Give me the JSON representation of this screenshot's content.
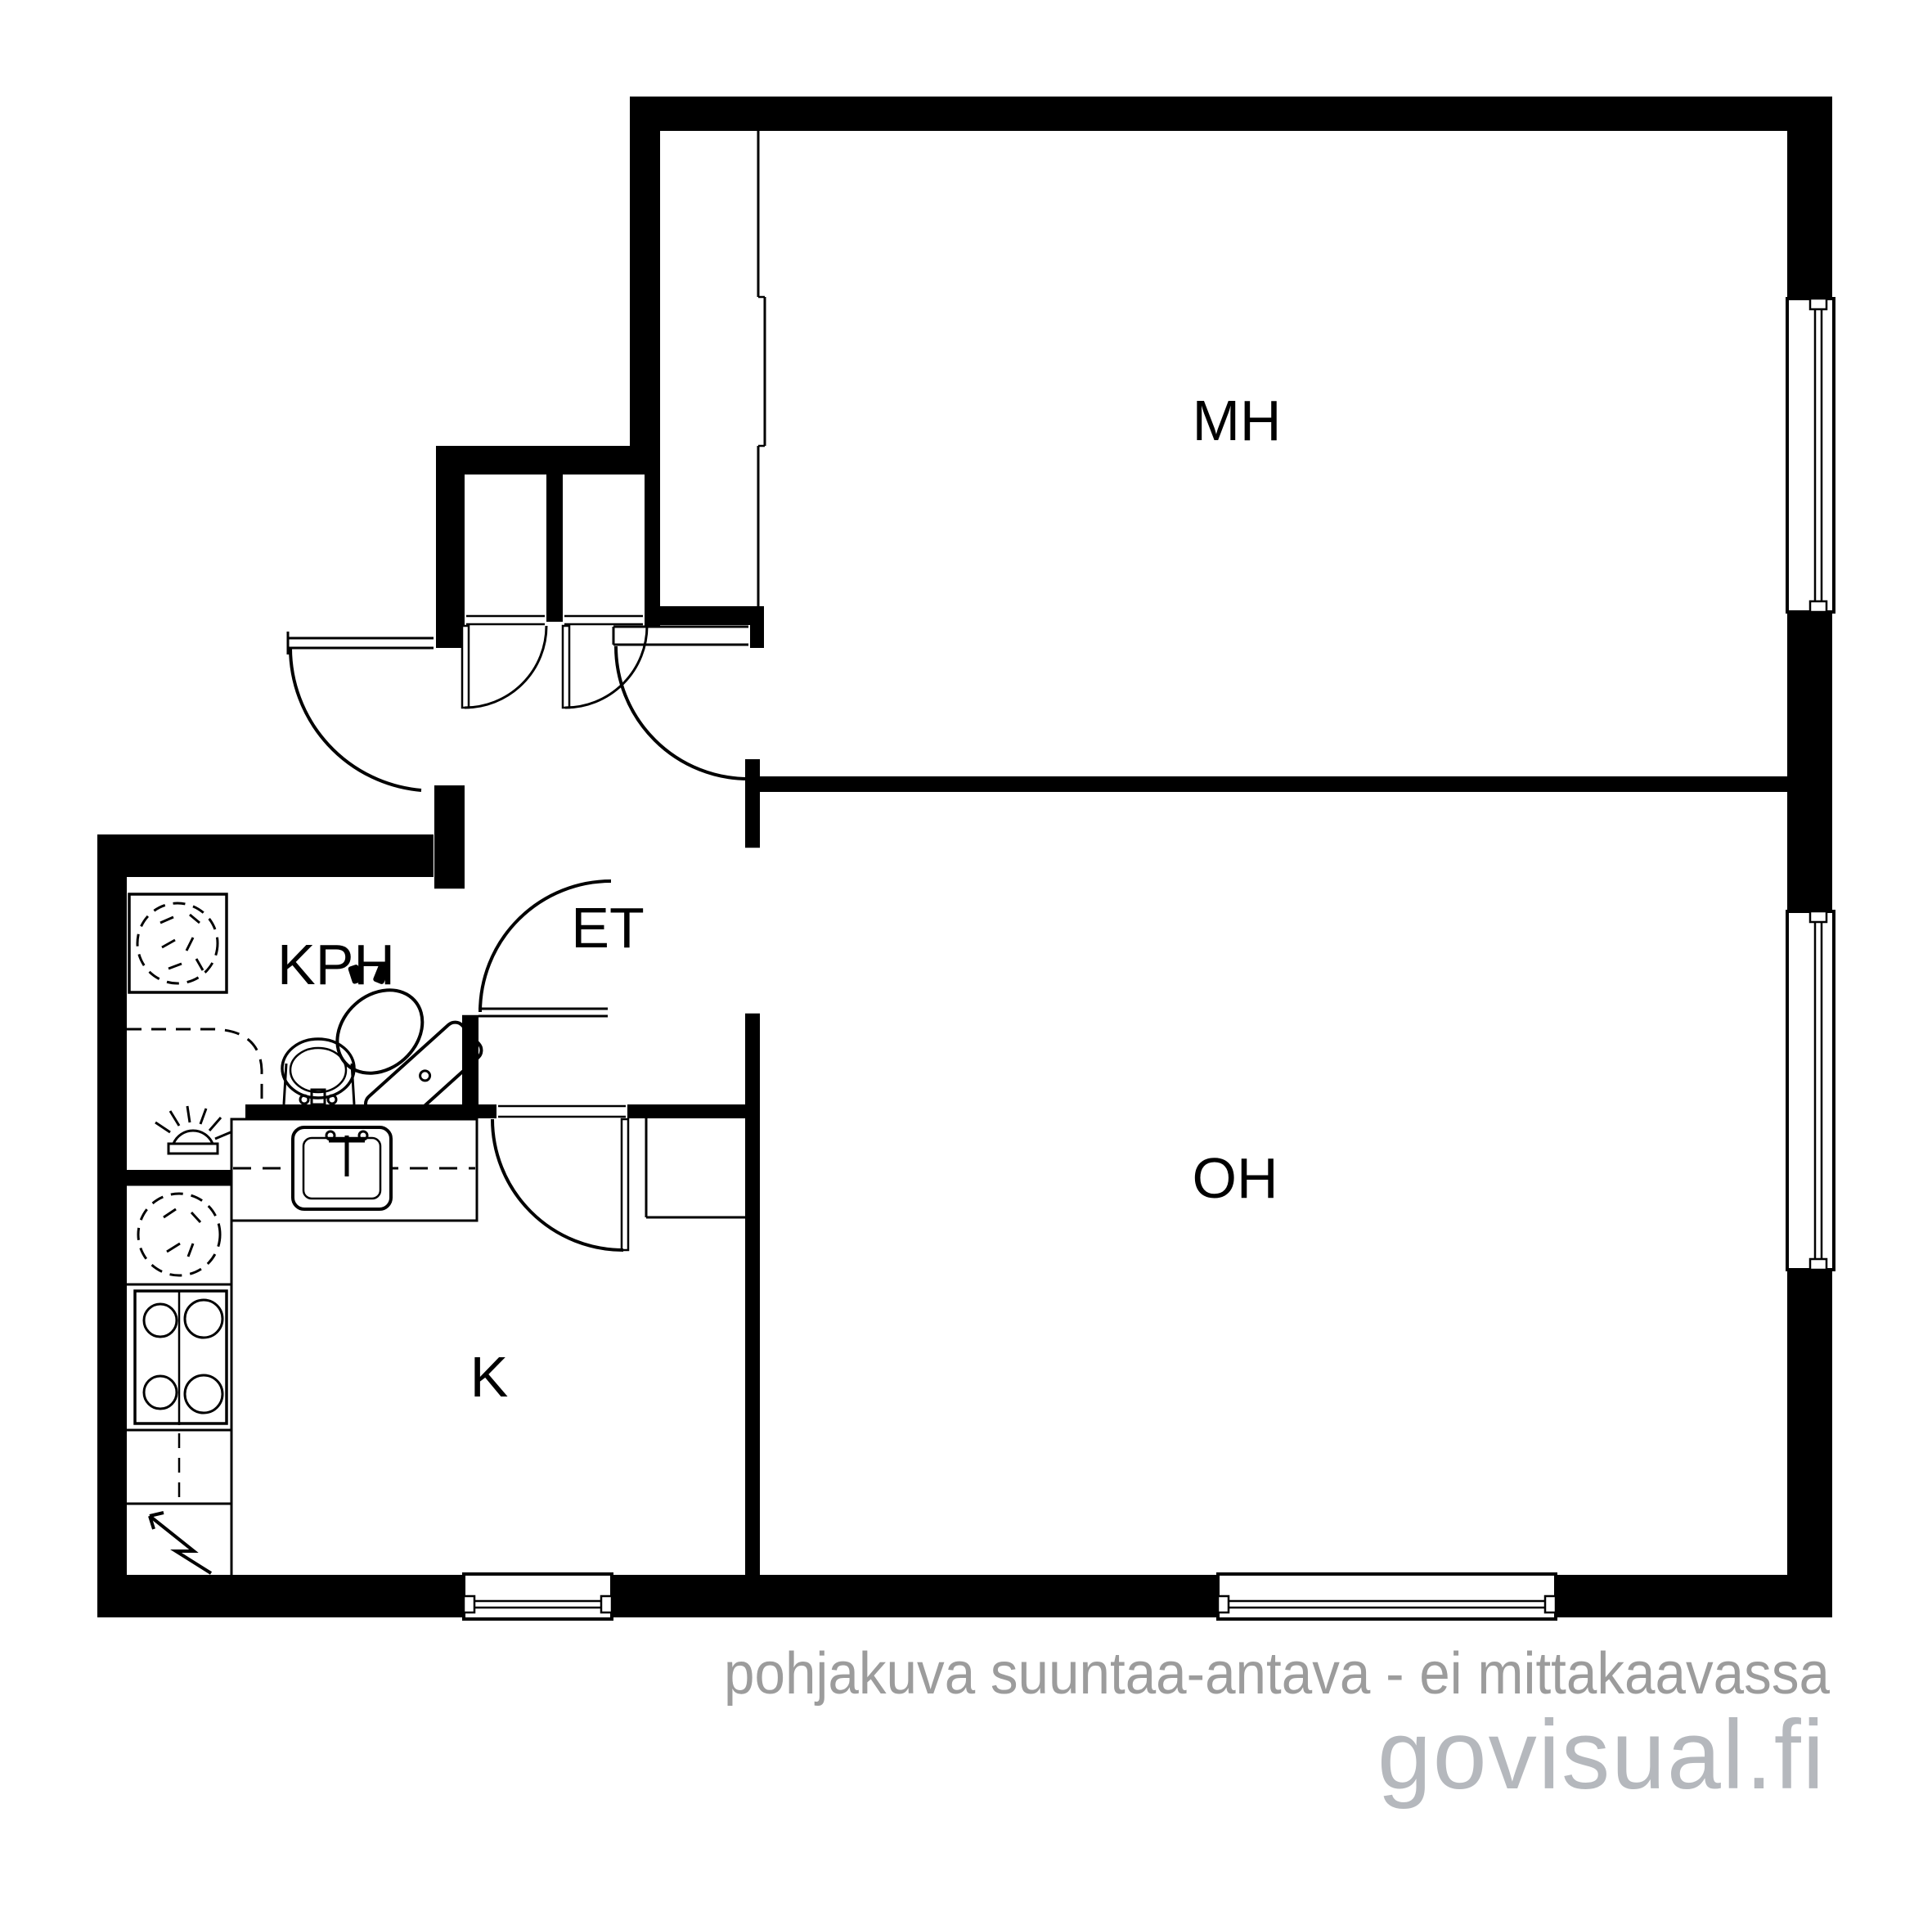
{
  "document": {
    "kind": "apartment floor plan",
    "language": "Finnish"
  },
  "rooms": [
    {
      "id": "MH",
      "label": "MH",
      "meaning": "makuuhuone / bedroom"
    },
    {
      "id": "OH",
      "label": "OH",
      "meaning": "olohuone / living room"
    },
    {
      "id": "ET",
      "label": "ET",
      "meaning": "eteinen / entry hall"
    },
    {
      "id": "KPH",
      "label": "KPH",
      "meaning": "kylpyhuone / bathroom"
    },
    {
      "id": "K",
      "label": "K",
      "meaning": "keittiö / kitchen"
    }
  ],
  "watermark": {
    "tagline": "pohjakuva suuntaa-antava - ei mittakaavassa",
    "brand": "govisual.fi"
  },
  "colors": {
    "wall": "#000000",
    "background": "#ffffff",
    "line": "#000000",
    "tagline_gray": "#9c9c9c",
    "brand_gray": "#b5b8bd"
  },
  "fixtures": [
    "washing-machine-icon",
    "hand-basin-icon",
    "toilet-icon",
    "floor-drain-lamp-icon",
    "fridge-icon",
    "stove-icon",
    "electrical-lightning-icon",
    "kitchen-sink-icon",
    "wardrobe-sliding-front-icon"
  ],
  "openings": {
    "windows": 4,
    "door_arcs": 6,
    "open_passages": 2
  }
}
